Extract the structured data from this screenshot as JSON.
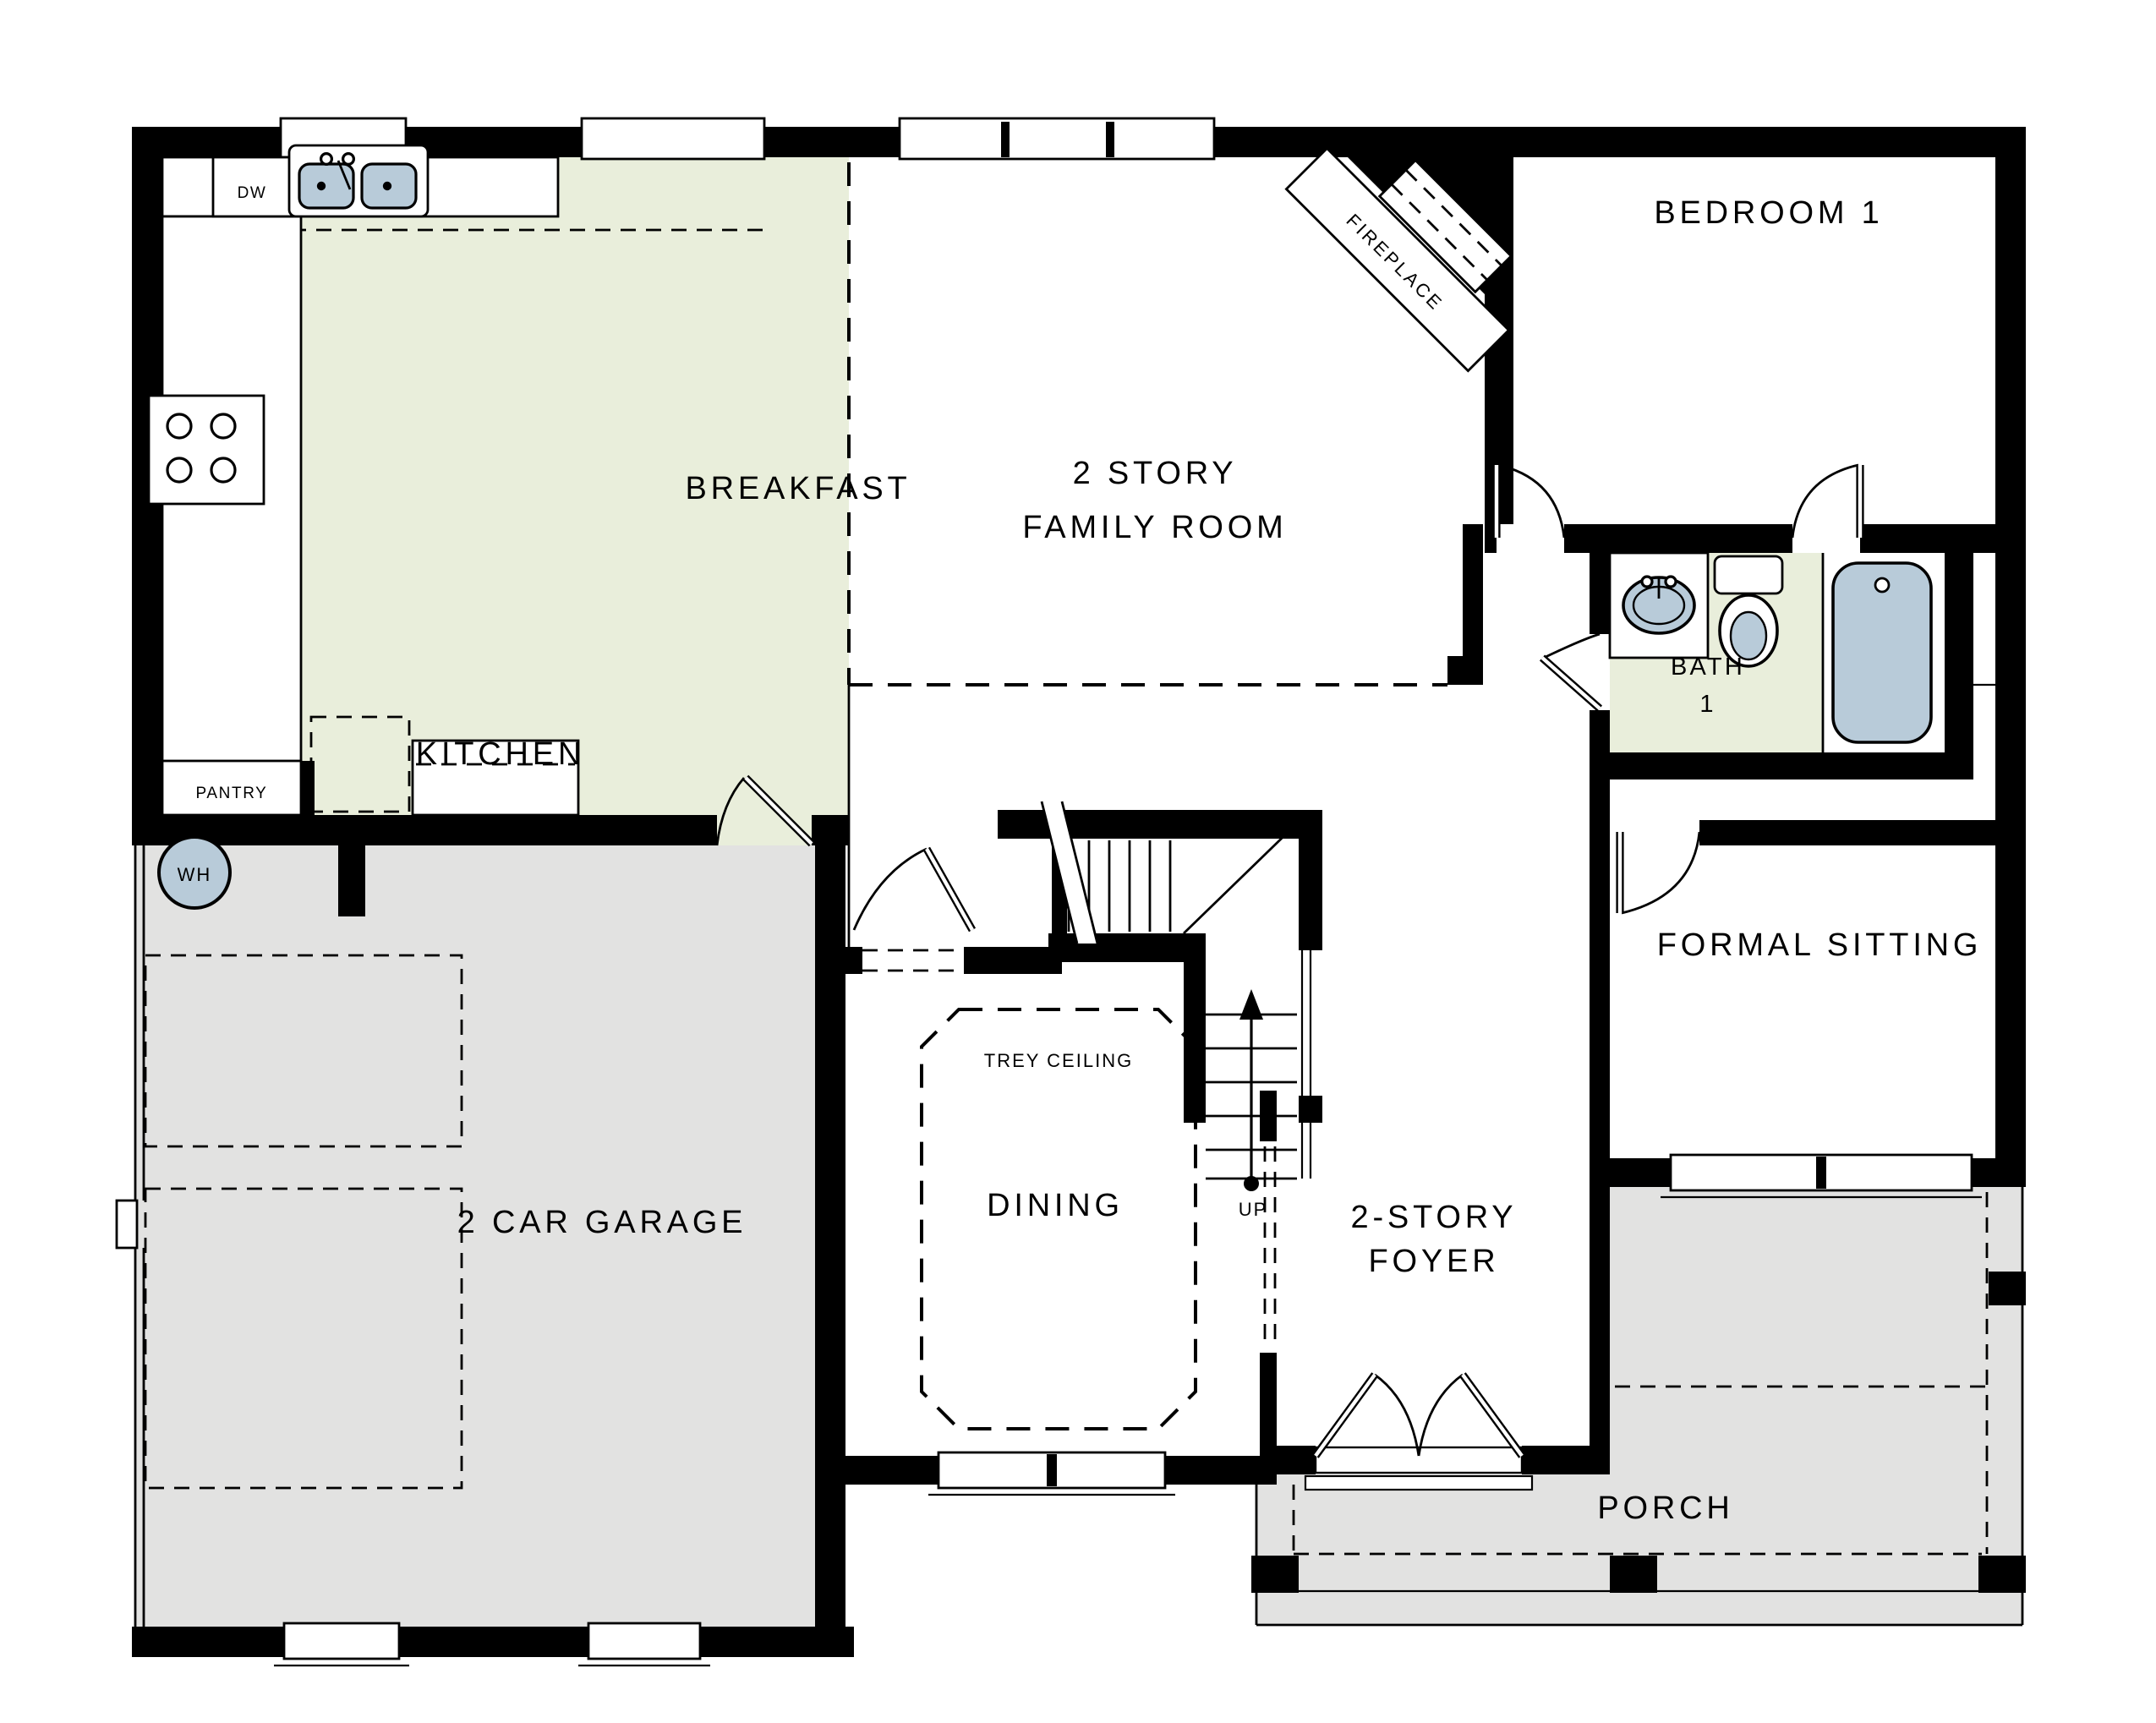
{
  "title": "First Floor Plan",
  "colors": {
    "background": "#ffffff",
    "wall_black": "#000000",
    "floor_green": "#e9eedb",
    "floor_gray": "#e2e2e1",
    "fixture_blue": "#b8cbd9"
  },
  "rooms": {
    "breakfast": {
      "label": "BREAKFAST"
    },
    "kitchen": {
      "label": "KITCHEN"
    },
    "family": {
      "lines": [
        "2 STORY",
        "FAMILY ROOM"
      ]
    },
    "bedroom1": {
      "label": "BEDROOM 1"
    },
    "bath1": {
      "lines": [
        "BATH",
        "1"
      ]
    },
    "formal_sitting": {
      "label": "FORMAL SITTING"
    },
    "garage": {
      "label": "2 CAR GARAGE"
    },
    "dining": {
      "label": "DINING"
    },
    "foyer": {
      "lines": [
        "2-STORY",
        "FOYER"
      ]
    },
    "porch": {
      "label": "PORCH"
    }
  },
  "annotations": {
    "pantry": "PANTRY",
    "dishwasher": "DW",
    "water_heater": "WH",
    "fireplace": "FIREPLACE",
    "trey_ceiling": "TREY CEILING",
    "stairs_up": "UP"
  }
}
